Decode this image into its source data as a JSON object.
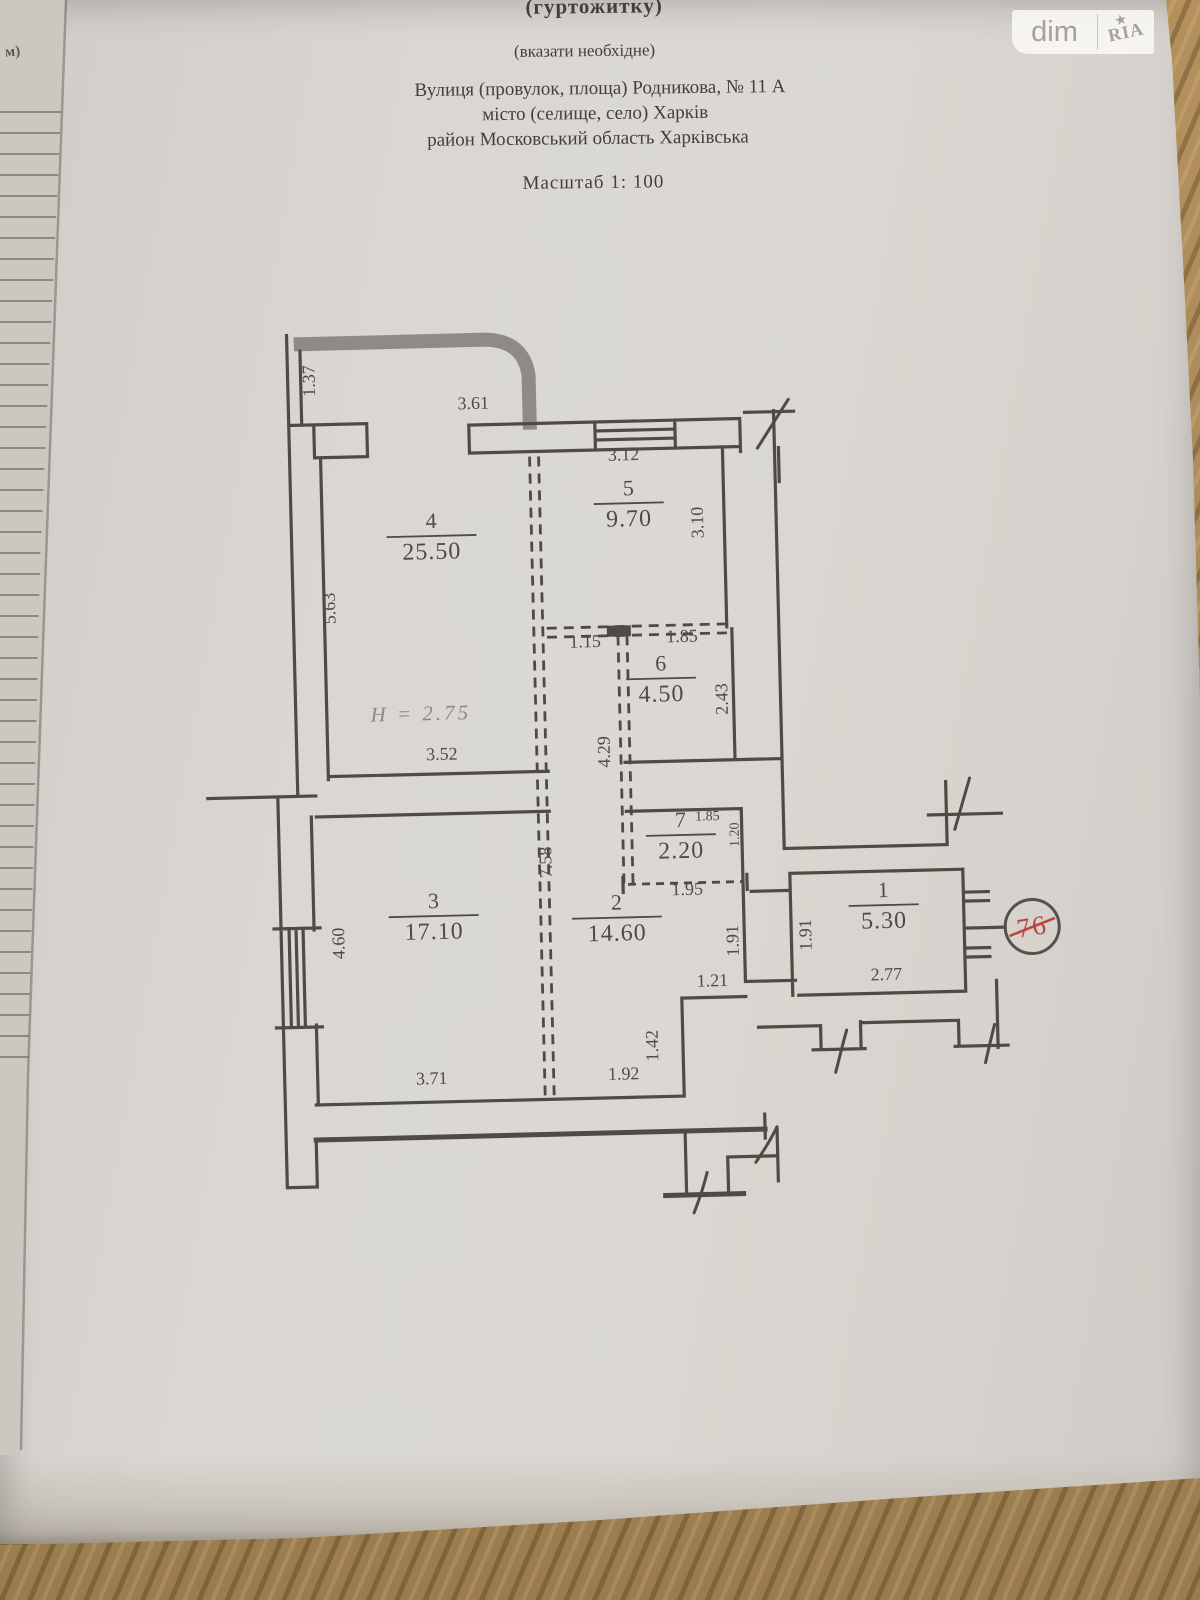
{
  "document": {
    "type_line": "(гуртожитку)",
    "note_line": "(вказати необхідне)",
    "address_line": "Вулиця (провулок, площа)  Родникова, №  11 А",
    "city_line": "місто (селище, село) Харків",
    "district_line": "район   Московський  область Харківська",
    "scale_line": "Масштаб 1: 100"
  },
  "watermark": {
    "left": "dim",
    "right": "RIA",
    "star": "★"
  },
  "margin_note": "м)",
  "plan": {
    "height_note": "Н = 2.75",
    "apartment_number": "76",
    "rooms": [
      {
        "number": "4",
        "area": "25.50",
        "x": 437,
        "y": 540
      },
      {
        "number": "5",
        "area": "9.70",
        "x": 635,
        "y": 512
      },
      {
        "number": "6",
        "area": "4.50",
        "x": 663,
        "y": 688
      },
      {
        "number": "7",
        "area": "2.20",
        "x": 679,
        "y": 845
      },
      {
        "number": "3",
        "area": "17.10",
        "x": 430,
        "y": 920
      },
      {
        "number": "2",
        "area": "14.60",
        "x": 613,
        "y": 926
      },
      {
        "number": "1",
        "area": "5.30",
        "x": 880,
        "y": 920
      }
    ],
    "dimensions": [
      {
        "t": "1.37",
        "x": 324,
        "y": 374,
        "r": -90
      },
      {
        "t": "3.61",
        "x": 482,
        "y": 406
      },
      {
        "t": "3.12",
        "x": 631,
        "y": 461
      },
      {
        "t": "3.10",
        "x": 709,
        "y": 525,
        "r": -90
      },
      {
        "t": "1.15",
        "x": 588,
        "y": 647
      },
      {
        "t": "1.85",
        "x": 685,
        "y": 644
      },
      {
        "t": "2.43",
        "x": 729,
        "y": 702,
        "r": -90
      },
      {
        "t": "4.29",
        "x": 610,
        "y": 752,
        "r": -90
      },
      {
        "t": "5.63",
        "x": 339,
        "y": 602,
        "r": -90
      },
      {
        "t": "3.52",
        "x": 442,
        "y": 756
      },
      {
        "t": "1.85",
        "x": 706,
        "y": 823,
        "small": true
      },
      {
        "t": "1.20",
        "x": 737,
        "y": 838,
        "r": -90,
        "small": true
      },
      {
        "t": "1.95",
        "x": 684,
        "y": 897
      },
      {
        "t": "7.58",
        "x": 549,
        "y": 861,
        "r": -90
      },
      {
        "t": "4.60",
        "x": 340,
        "y": 937,
        "r": -90
      },
      {
        "t": "1.91",
        "x": 734,
        "y": 944,
        "r": -90
      },
      {
        "t": "1.21",
        "x": 707,
        "y": 989
      },
      {
        "t": "1.42",
        "x": 651,
        "y": 1047,
        "r": -90
      },
      {
        "t": "1.92",
        "x": 616,
        "y": 1080
      },
      {
        "t": "3.71",
        "x": 424,
        "y": 1080
      },
      {
        "t": "1.91",
        "x": 807,
        "y": 940,
        "r": -90
      },
      {
        "t": "2.77",
        "x": 881,
        "y": 987
      }
    ]
  },
  "colors": {
    "ink": "#4e4a44",
    "red": "#bf4440",
    "paper": "#d9d6d1",
    "wood": "#b0905e"
  }
}
